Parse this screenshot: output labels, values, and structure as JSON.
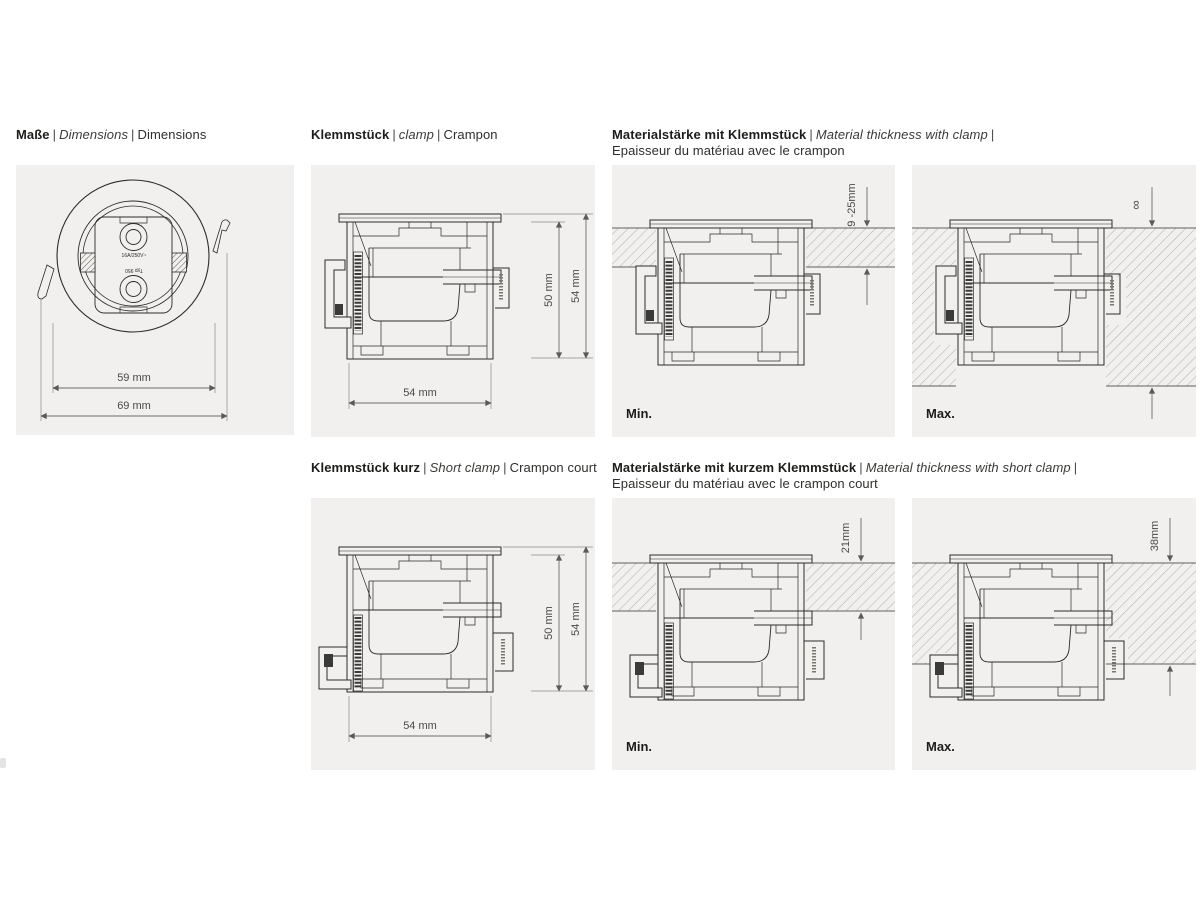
{
  "colors": {
    "page_bg": "#ffffff",
    "panel_bg": "#f1f0ee",
    "line": "#2b2b29",
    "dim_line": "#6b6b69",
    "text": "#1d1d1b",
    "dim_text": "#4a4a48"
  },
  "sep": "|",
  "panels": {
    "dimensions": {
      "title": {
        "de": "Maße",
        "en": "Dimensions",
        "fr": "Dimensions"
      },
      "front": {
        "rating": "16A/250V~",
        "type_label": "Typ 950",
        "dim_inner": "59 mm",
        "dim_outer": "69 mm"
      }
    },
    "clamp": {
      "title": {
        "de": "Klemmstück",
        "en": "clamp",
        "fr": "Crampon"
      },
      "dim_width": "54 mm",
      "dim_inner_height": "50 mm",
      "dim_total_height": "54 mm"
    },
    "material_clamp": {
      "title": {
        "de": "Materialstärke mit Klemmstück",
        "en": "Material thickness with clamp",
        "fr": "Epaisseur du matériau avec le crampon"
      },
      "min": {
        "caption": "Min.",
        "thickness": "9 -25mm"
      },
      "max": {
        "caption": "Max.",
        "thickness": "∞"
      }
    },
    "short_clamp": {
      "title": {
        "de": "Klemmstück kurz",
        "en": "Short clamp",
        "fr": "Crampon court"
      },
      "dim_width": "54 mm",
      "dim_inner_height": "50 mm",
      "dim_total_height": "54 mm"
    },
    "material_short_clamp": {
      "title": {
        "de": "Materialstärke mit kurzem Klemmstück",
        "en": "Material thickness with short clamp",
        "fr": "Epaisseur du matériau avec le crampon court"
      },
      "min": {
        "caption": "Min.",
        "thickness": "21mm"
      },
      "max": {
        "caption": "Max.",
        "thickness": "38mm"
      }
    }
  }
}
